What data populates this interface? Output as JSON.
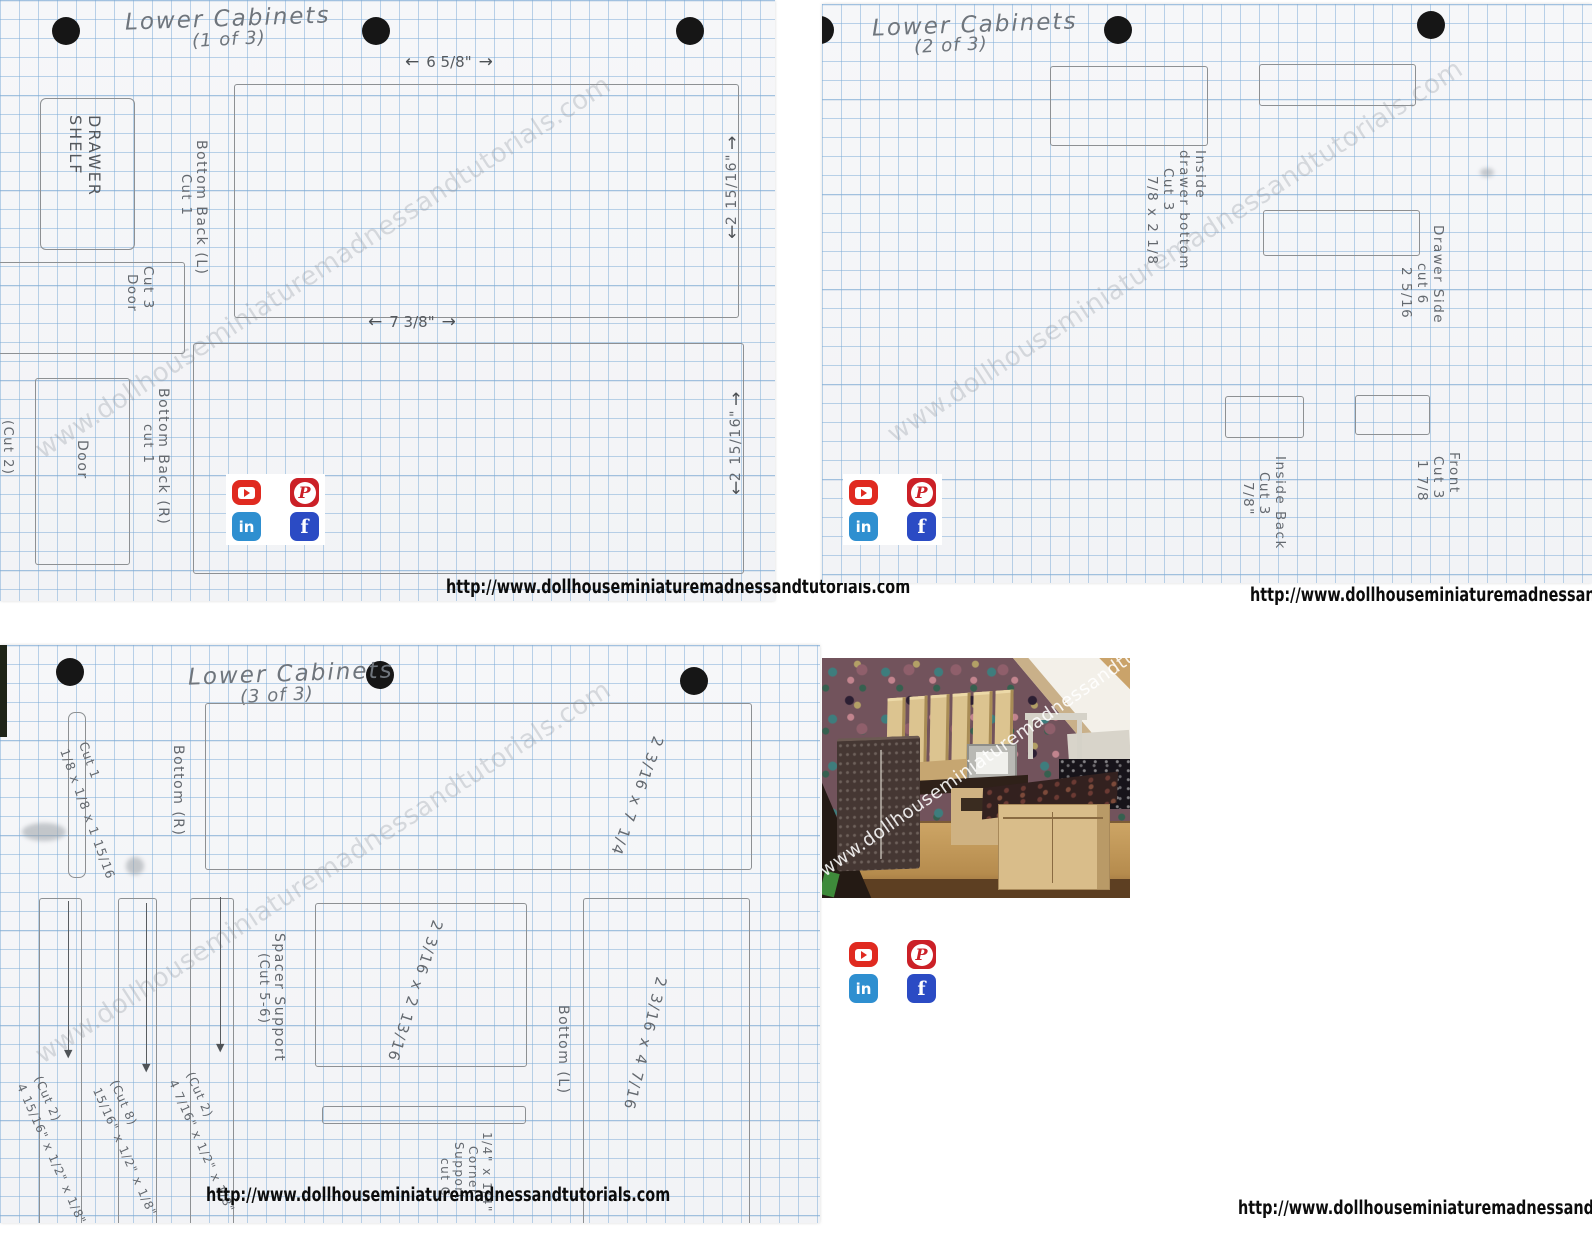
{
  "watermark": "www.dollhouseminiaturemadnessandtutorials.com",
  "footer_url": "http://www.dollhouseminiaturemadnessandtutorials.com",
  "colors": {
    "youtube": "#e02a20",
    "pinterest": "#cb2027",
    "linkedin": "#2e8fd0",
    "facebook": "#2b4bc4",
    "grid_blue": "#7aaad6",
    "pencil": "#64696f"
  },
  "icons": {
    "arrow_left": "←",
    "arrow_right": "→",
    "arrow_up": "↑",
    "arrow_down": "↓",
    "arrow_head_down": "▼",
    "pinterest_glyph": "P",
    "linkedin_glyph": "in",
    "facebook_glyph": "f"
  },
  "sheet1": {
    "title": "Lower Cabinets",
    "subtitle": "(1 of 3)",
    "dim_top": "6 5/8\"",
    "drawer_shelf_line1": "DRAWER",
    "drawer_shelf_line2": "SHELF",
    "bottom_back_l": "Bottom Back (L)",
    "bottom_back_l_cut": "Cut 1",
    "dim_right_top": "2 15/16\"",
    "cut3": "Cut 3",
    "cut3_part": "Door",
    "door": "Door",
    "cut2": "(Cut 2)",
    "bottom_back_r": "Bottom Back (R)",
    "bottom_back_r_cut": "cut 1",
    "dim_mid": "7 3/8\"",
    "dim_right_bottom": "2 15/16\""
  },
  "sheet2": {
    "title": "Lower Cabinets",
    "subtitle": "(2 of 3)",
    "inside_drawer": [
      "Inside",
      "drawer bottom",
      "Cut 3",
      "7/8 x 2 1/8"
    ],
    "drawer_side": [
      "Drawer Side",
      "cut 6",
      "2 5/16"
    ],
    "inside_back": [
      "Inside Back",
      "Cut 3",
      "7/8\""
    ],
    "front": [
      "Front",
      "Cut 3",
      "1 7/8"
    ]
  },
  "sheet3": {
    "title": "Lower Cabinets",
    "subtitle": "(3 of 3)",
    "cut1_label": "Cut 1",
    "cut1_dims": "1/8 x 1/8 x 1 15/16",
    "bottom_r": "Bottom (R)",
    "bottom_r_dims": "2 3/16 x 7 1/4",
    "spacer_support": "Spacer Support",
    "spacer_cut": "(Cut 5-6)",
    "square_dims": "2 3/16 x 2 13/16",
    "strip1_cut": "(Cut 2)",
    "strip1_dims": "4 15/16\" x 1/2\" x 1/8\"",
    "strip2_cut": "(Cut 8)",
    "strip2_dims": "15/16\" x 1/2\" x 1/8\"",
    "strip3_cut": "(Cut 2)",
    "strip3_dims": "4 7/16\" x 1/2\" x 1/8\"",
    "corner": [
      "1/4\" x 1/4\"",
      "Corner",
      "Support",
      "cut C"
    ],
    "bottom_l": "Bottom (L)",
    "bottom_l_dims": "2 3/16 x 4 7/16"
  }
}
